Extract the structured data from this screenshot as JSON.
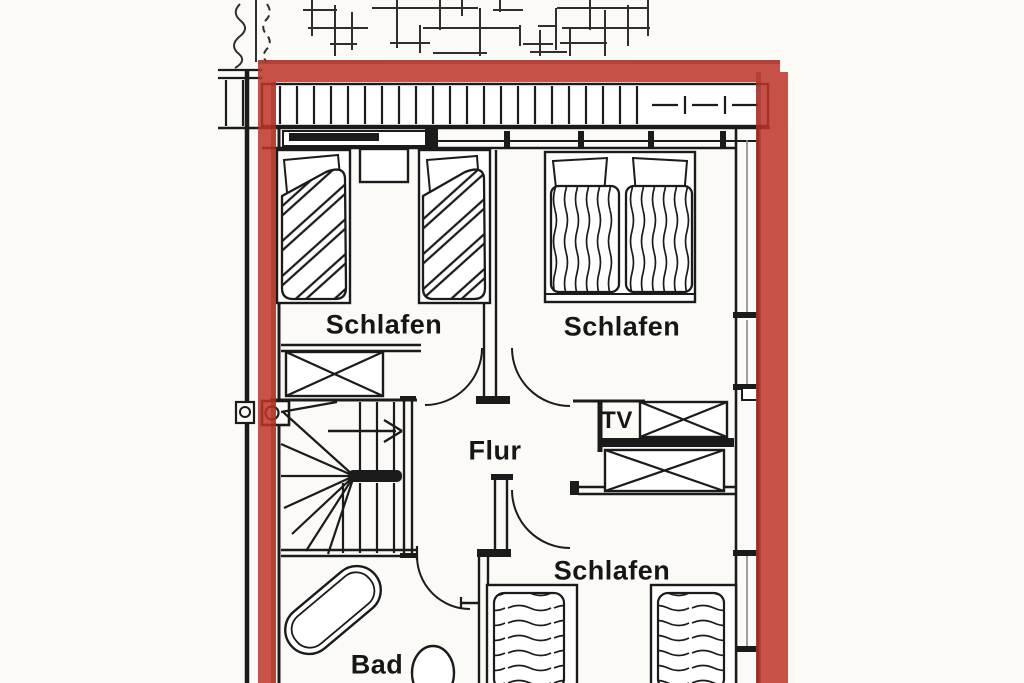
{
  "meta": {
    "kind": "floor-plan-scan",
    "language": "de"
  },
  "colors": {
    "boundary_marker_red": "#bd3428",
    "ink": "#1b1b1b",
    "paper": "#fbfaf7"
  },
  "rooms": {
    "bedroom_top_left": {
      "label": "Schlafen"
    },
    "bedroom_top_right": {
      "label": "Schlafen"
    },
    "hallway": {
      "label": "Flur"
    },
    "bedroom_bottom": {
      "label": "Schlafen"
    },
    "bathroom": {
      "label": "Bad"
    },
    "tv_niche": {
      "label": "TV"
    }
  }
}
